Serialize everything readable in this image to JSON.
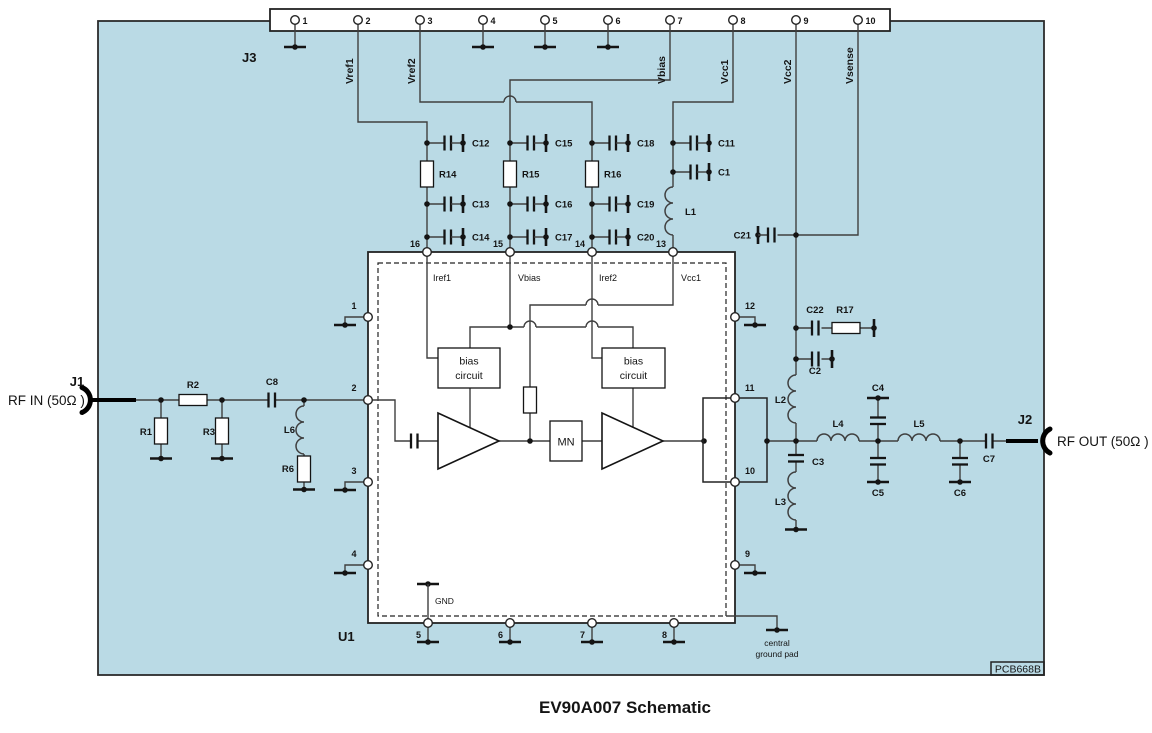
{
  "title": "EV90A007 Schematic",
  "pcb": {
    "code": "PCB668B"
  },
  "colors": {
    "board": "#badae5",
    "wire": "#3f3f3f",
    "ink": "#141414"
  },
  "j3": {
    "label": "J3",
    "pin_numbers": [
      "1",
      "2",
      "3",
      "4",
      "5",
      "6",
      "7",
      "8",
      "9",
      "10"
    ],
    "signals": {
      "vref1": "Vref1",
      "vref2": "Vref2",
      "vbias": "Vbias",
      "vcc1": "Vcc1",
      "vcc2": "Vcc2",
      "vsense": "Vsense"
    }
  },
  "rf_in": {
    "connector": "J1",
    "label": "RF IN (50Ω )"
  },
  "rf_out": {
    "connector": "J2",
    "label": "RF OUT (50Ω )"
  },
  "u1": {
    "label": "U1",
    "pin_numbers": [
      "1",
      "2",
      "3",
      "4",
      "5",
      "6",
      "7",
      "8",
      "9",
      "10",
      "11",
      "12",
      "13",
      "14",
      "15",
      "16"
    ],
    "internal": {
      "iref1": "Iref1",
      "vbias": "Vbias",
      "iref2": "Iref2",
      "vcc1": "Vcc1",
      "gnd": "GND",
      "mn": "MN",
      "bias_line1": "bias",
      "bias_line2": "circuit"
    },
    "central_pad_line1": "central",
    "central_pad_line2": "ground pad"
  },
  "components": {
    "c1": "C1",
    "c2": "C2",
    "c3": "C3",
    "c4": "C4",
    "c5": "C5",
    "c6": "C6",
    "c7": "C7",
    "c8": "C8",
    "c11": "C11",
    "c12": "C12",
    "c13": "C13",
    "c14": "C14",
    "c15": "C15",
    "c16": "C16",
    "c17": "C17",
    "c18": "C18",
    "c19": "C19",
    "c20": "C20",
    "c21": "C21",
    "c22": "C22",
    "r1": "R1",
    "r2": "R2",
    "r3": "R3",
    "r6": "R6",
    "r14": "R14",
    "r15": "R15",
    "r16": "R16",
    "r17": "R17",
    "l1": "L1",
    "l2": "L2",
    "l3": "L3",
    "l4": "L4",
    "l5": "L5",
    "l6": "L6"
  }
}
